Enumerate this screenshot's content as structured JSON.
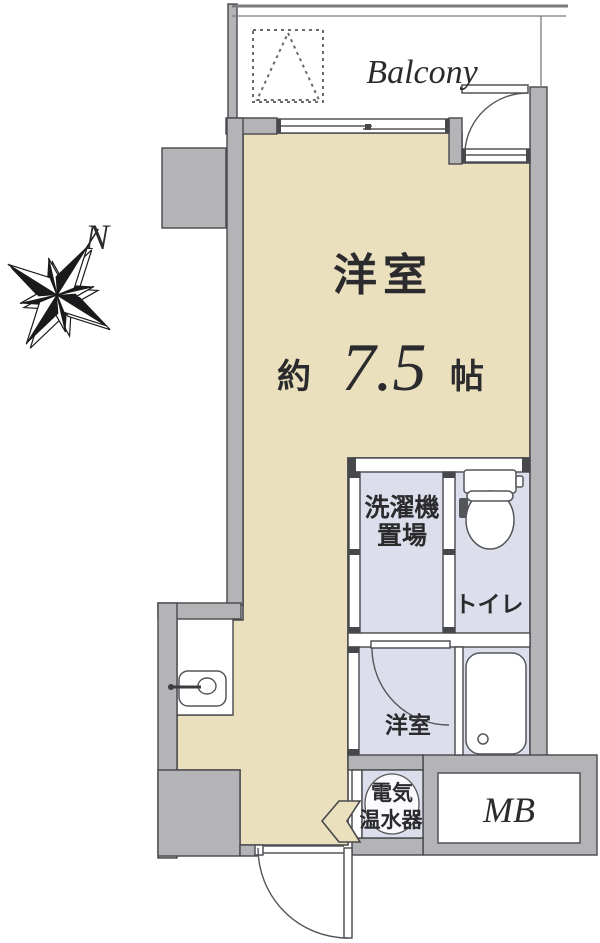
{
  "floor_plan": {
    "balcony_label": "Balcony",
    "main_room": {
      "name": "洋室",
      "size_prefix": "約",
      "size_value": "7.5",
      "size_unit": "帖"
    },
    "laundry": {
      "line1": "洗濯機",
      "line2": "置場"
    },
    "toilet_label": "トイレ",
    "hall_label": "洋室",
    "water_heater": {
      "line1": "電気",
      "line2": "温水器"
    },
    "meter_box_label": "MB",
    "compass_label": "N",
    "colors": {
      "room": "#EAE0BE",
      "wet": "#DCDFEB",
      "wall": "#B4B4B6",
      "line": "#47484C",
      "fix": "#55565A",
      "text": "#2B2B2E"
    }
  }
}
